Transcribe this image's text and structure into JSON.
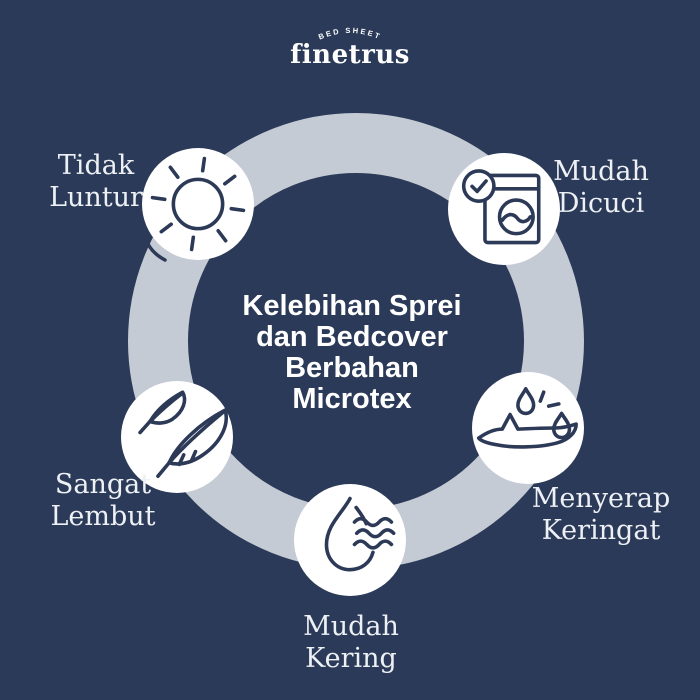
{
  "brand": {
    "tagline": "BED SHEET",
    "name": "finetrus"
  },
  "diagram": {
    "title": "Kelebihan Sprei\ndan Bedcover\nBerbahan\nMicrotex",
    "nodes": [
      {
        "label": "Tidak\nLuntur",
        "icon": "sun-icon"
      },
      {
        "label": "Mudah\nDicuci",
        "icon": "washing-machine-check-icon"
      },
      {
        "label": "Sangat\nLembut",
        "icon": "feather-icon"
      },
      {
        "label": "Menyerap\nKeringat",
        "icon": "sweat-absorb-icon"
      },
      {
        "label": "Mudah\nKering",
        "icon": "water-drop-wind-icon"
      }
    ]
  },
  "colors": {
    "background": "#2b3a58",
    "ring": "#c5cbd4",
    "node_fill": "#ffffff",
    "icon_stroke": "#2c3a57",
    "title_text": "#ffffff",
    "label_text": "#edf0f4"
  }
}
